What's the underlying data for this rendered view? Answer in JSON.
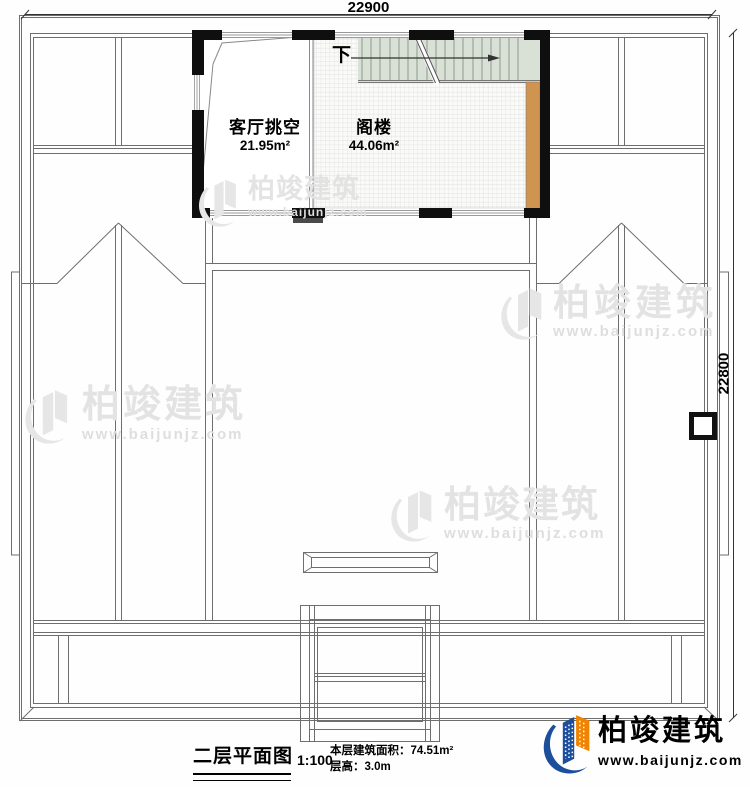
{
  "dimensions": {
    "top": "22900",
    "right": "22800"
  },
  "rooms": [
    {
      "name": "客厅挑空",
      "area": "21.95m²"
    },
    {
      "name": "阁楼",
      "area": "44.06m²"
    }
  ],
  "stairs": {
    "direction_label": "下"
  },
  "title_block": {
    "title": "二层平面图",
    "scale": "1:100",
    "floor_area": "本层建筑面积：74.51m²",
    "floor_height": "层高：3.0m"
  },
  "brand": {
    "name": "柏竣建筑",
    "website": "www.baijunjz.com",
    "colors": {
      "blue": "#1b4f9c",
      "orange": "#f08300"
    }
  },
  "watermark": {
    "name": "柏竣建筑",
    "website": "www.baijunjz.com"
  }
}
